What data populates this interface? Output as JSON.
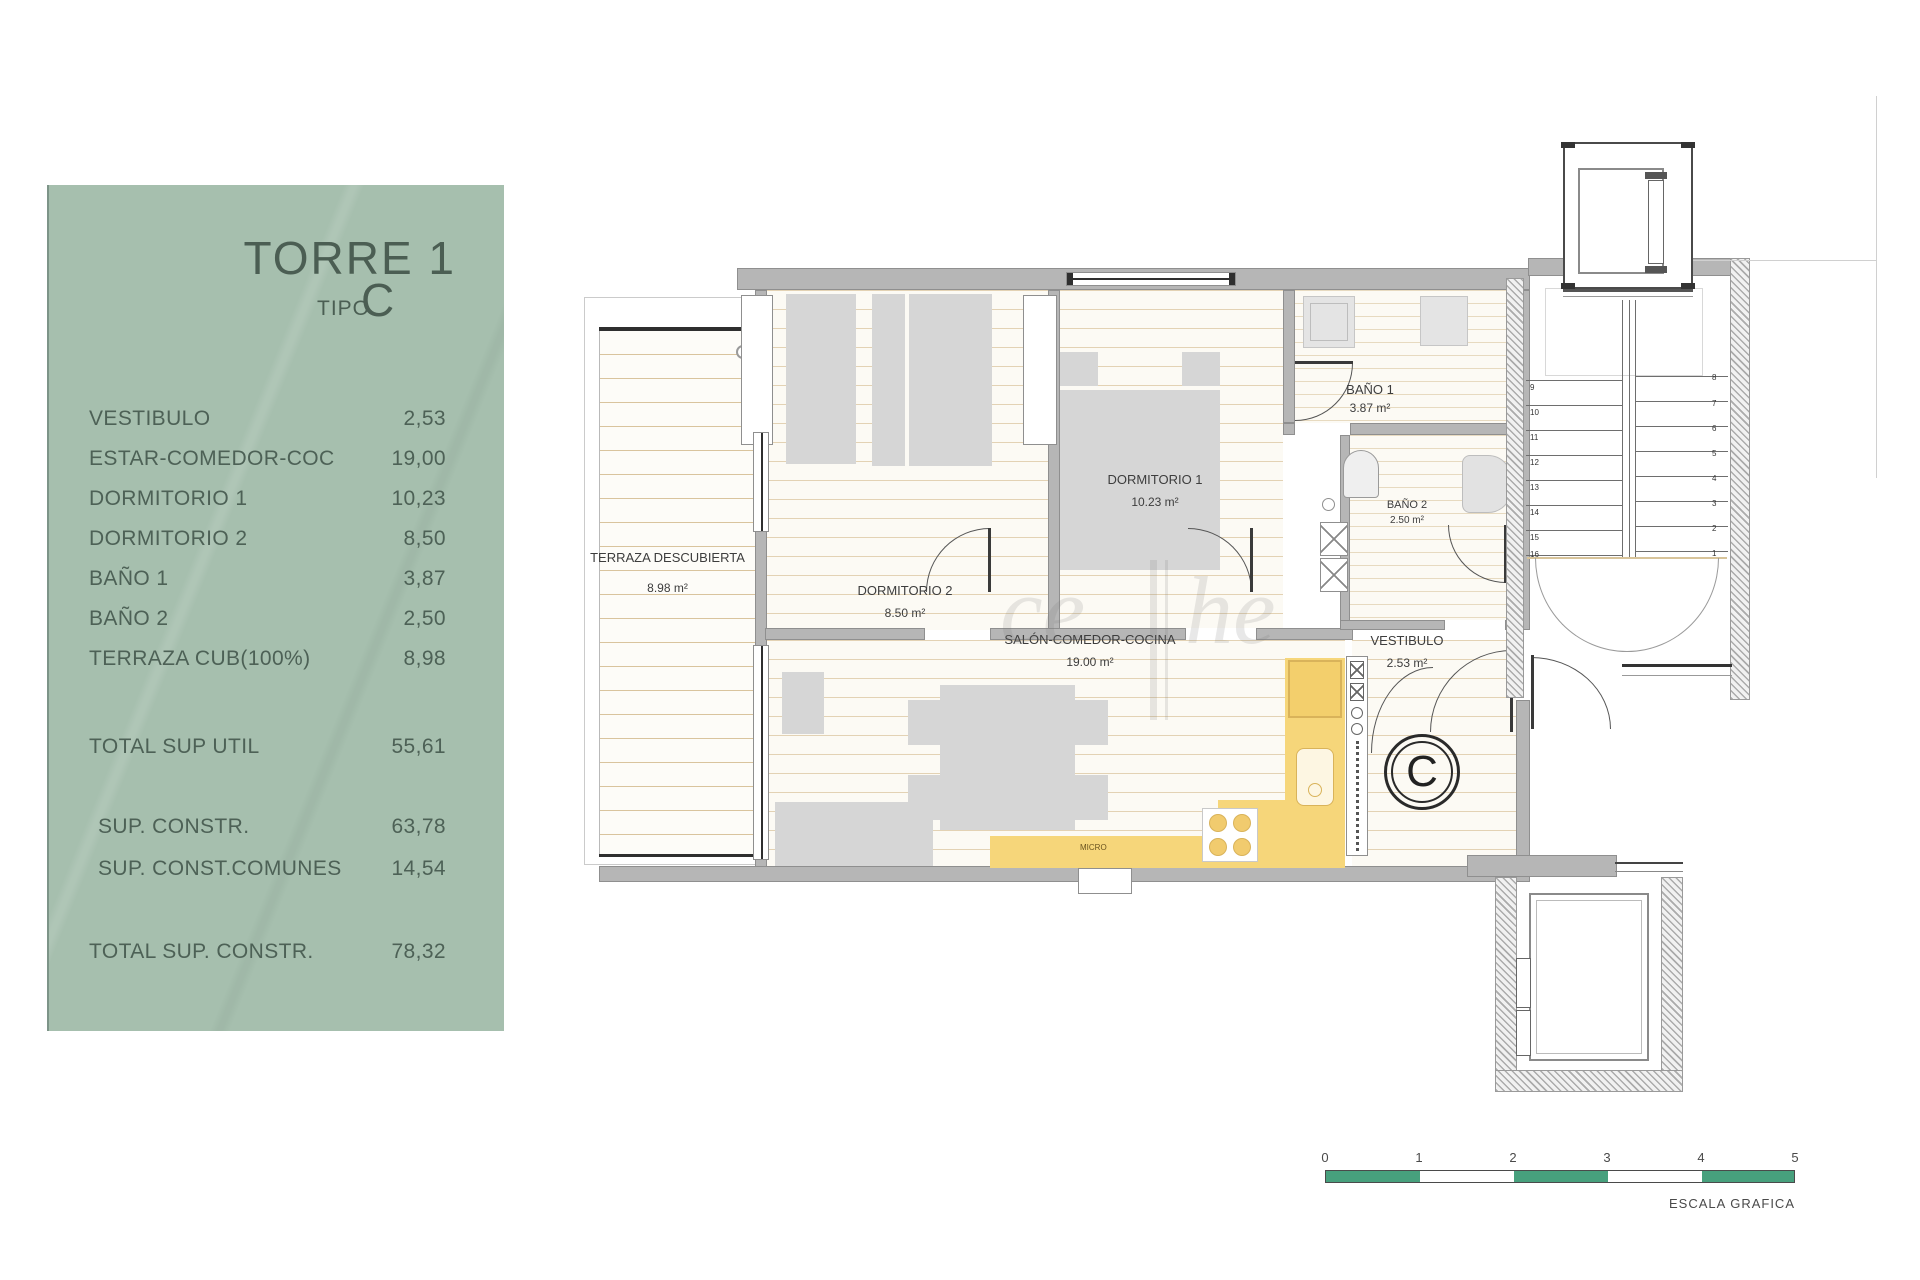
{
  "panel": {
    "title": "TORRE 1",
    "tipo_label": "TIPO",
    "tipo_value": "C",
    "rows": [
      {
        "label": "VESTIBULO",
        "value": "2,53"
      },
      {
        "label": "ESTAR-COMEDOR-COC",
        "value": "19,00"
      },
      {
        "label": "DORMITORIO 1",
        "value": "10,23"
      },
      {
        "label": "DORMITORIO 2",
        "value": "8,50"
      },
      {
        "label": "BAÑO 1",
        "value": "3,87"
      },
      {
        "label": "BAÑO 2",
        "value": "2,50"
      },
      {
        "label": "TERRAZA CUB(100%)",
        "value": "8,98"
      }
    ],
    "totals": [
      {
        "label": "TOTAL SUP UTIL",
        "value": "55,61"
      },
      {
        "label": "SUP. CONSTR.",
        "value": "63,78"
      },
      {
        "label": "SUP. CONST.COMUNES",
        "value": "14,54"
      },
      {
        "label": "TOTAL SUP. CONSTR.",
        "value": "78,32"
      }
    ]
  },
  "plan": {
    "rooms": [
      {
        "name": "TERRAZA DESCUBIERTA",
        "area": "8.98 m²"
      },
      {
        "name": "DORMITORIO 2",
        "area": "8.50 m²"
      },
      {
        "name": "DORMITORIO 1",
        "area": "10.23 m²"
      },
      {
        "name": "BAÑO 1",
        "area": "3.87 m²"
      },
      {
        "name": "BAÑO 2",
        "area": "2.50 m²"
      },
      {
        "name": "SALÓN-COMEDOR-COCINA",
        "area": "19.00 m²"
      },
      {
        "name": "VESTIBULO",
        "area": "2.53 m²"
      }
    ],
    "micro_label": "MICRO",
    "unit_marker": "C",
    "stairs": {
      "left_steps": [
        "9",
        "10",
        "11",
        "12",
        "13",
        "14",
        "15",
        "16"
      ],
      "right_steps": [
        "8",
        "7",
        "6",
        "5",
        "4",
        "3",
        "2",
        "1"
      ]
    }
  },
  "scale_bar": {
    "ticks": [
      "0",
      "1",
      "2",
      "3",
      "4",
      "5"
    ],
    "caption": "ESCALA GRAFICA",
    "green_color": "#47a07d"
  },
  "colors": {
    "panel_green": "#a6bfae",
    "kitchen_yellow": "#f6d67a",
    "wall_gray": "#b6b6b6"
  },
  "watermark": {
    "left": "ce",
    "right": "he"
  }
}
